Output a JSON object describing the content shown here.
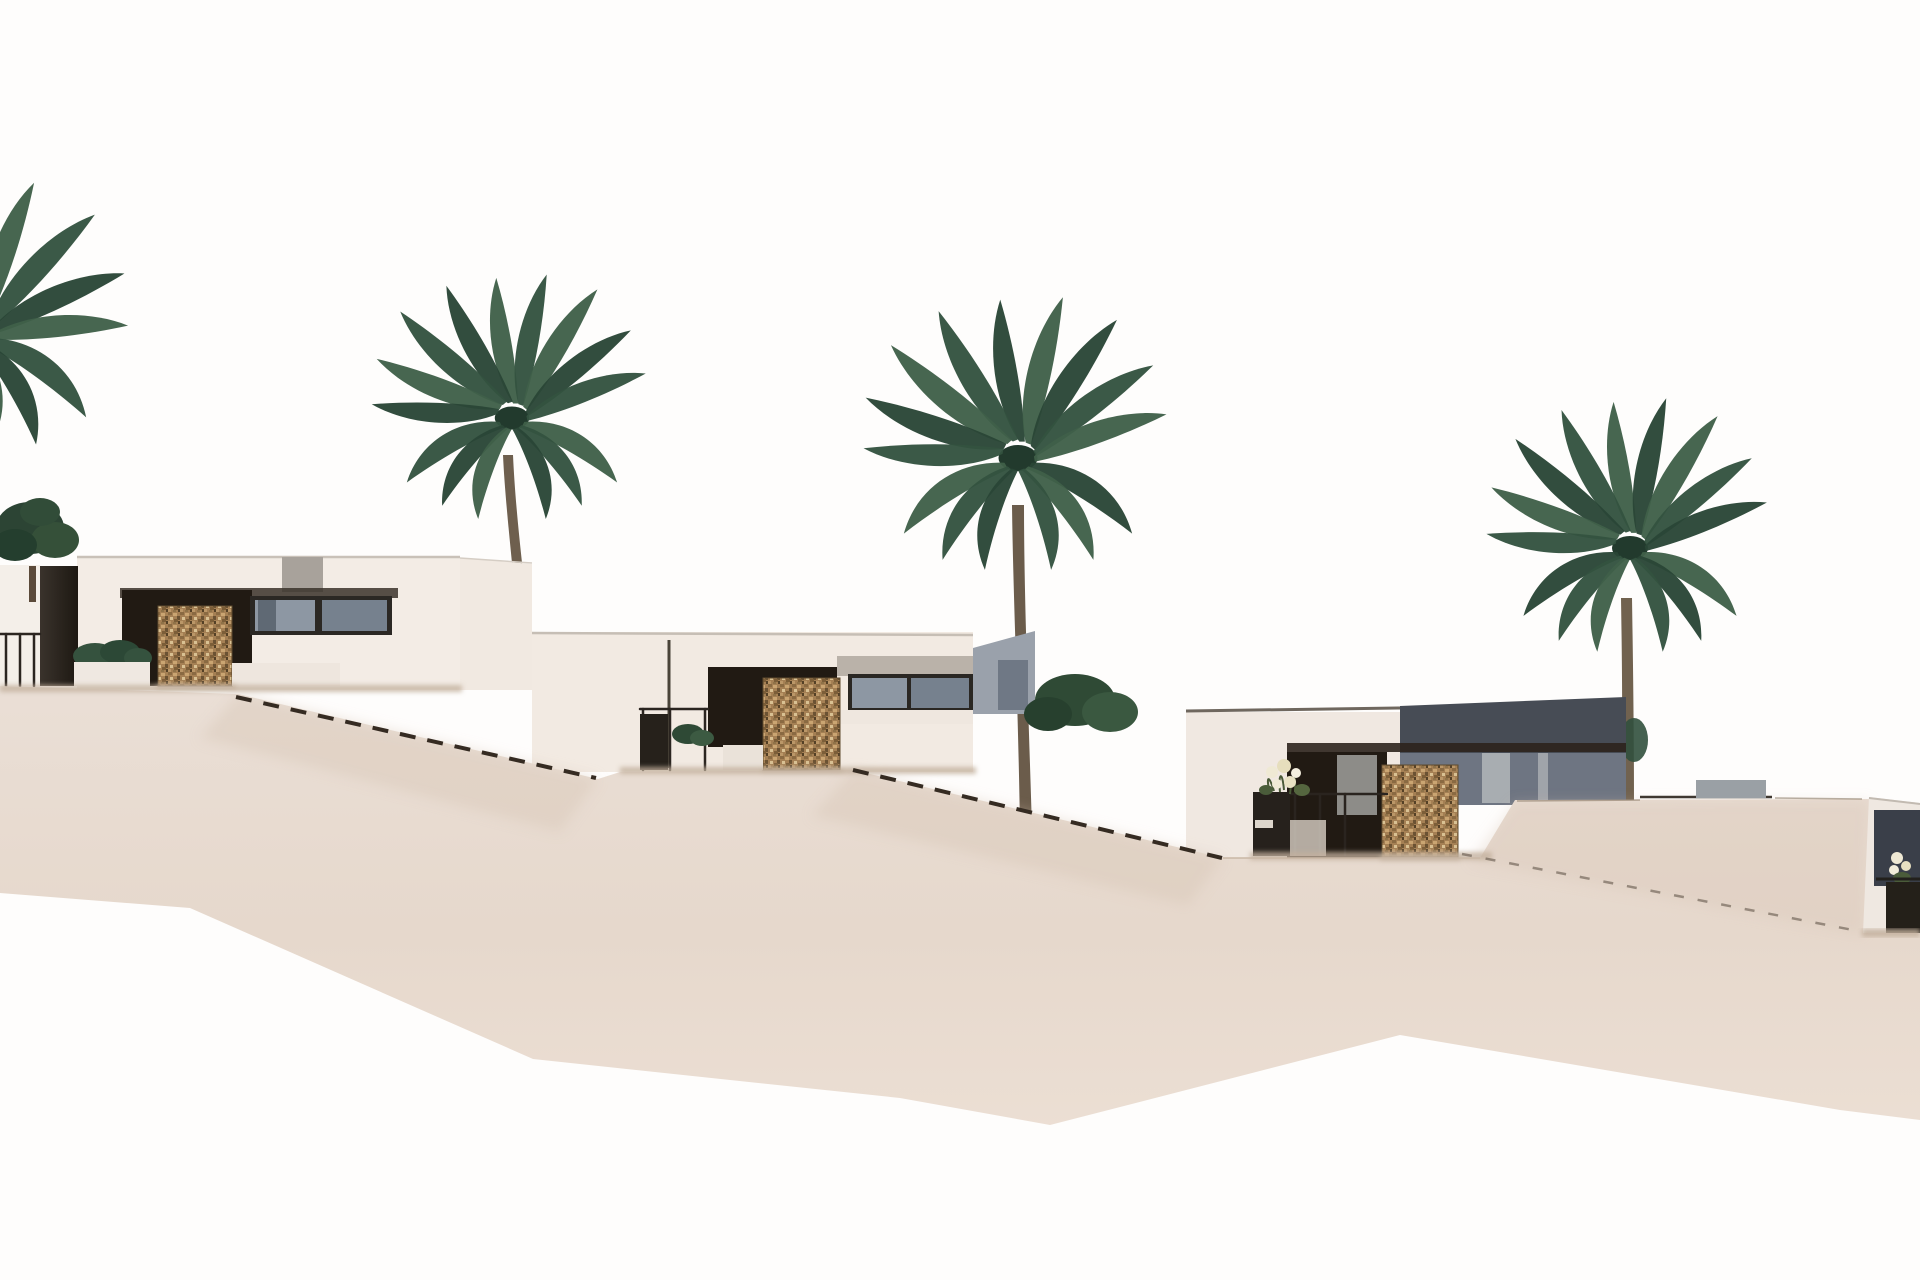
{
  "meta": {
    "image_type": "architectural-3d-render",
    "description": "New-build modern villas on a terraced sandy hillside with palm trees against a white sky",
    "width_px": 1920,
    "height_px": 1280
  },
  "colors": {
    "sky": "#fefdfc",
    "sand": "#e8dcd2",
    "sandTop": "#ebe0d7",
    "sandDeep": "#e4d5c8",
    "bankShade": "#d8c5b4",
    "groundShadow": "#c3b09d",
    "wall1": "#f3ece5",
    "wall2": "#f2eae2",
    "wall3": "#f0e8e1",
    "wall4": "#efe8e1",
    "roofLine": "#c9c1b8",
    "roofLine3": "#6f675e",
    "eave": "#3a322a",
    "porch": "#211a13",
    "glassA": "#8d97a3",
    "glassB": "#76818e",
    "frame": "#2b2824",
    "wingGray": "#9aa1ab",
    "upperGray": "#474c55",
    "facadeGray": "#6e7582",
    "doorGray": "#8d8c88",
    "doorStripe": "#b3b7ba",
    "slabGray": "#9aa0a5",
    "stoneEdge": "#5e4a2e",
    "pillar": "#26211b",
    "rail": "#2b2520",
    "dash": "#352b22",
    "dashFaint": "#4a3f33",
    "trunk": "#6e5f4e",
    "palmDark": "#2a4636",
    "palmMid": "#33523f",
    "palmLight": "#3f6049",
    "treeGreen": "#2c4434",
    "shrubGreen": "#35523e",
    "flowerCream": "#efe9d4",
    "planterDark": "#26211c",
    "benchWhite": "#eae2d9"
  },
  "scene": {
    "villas": [
      {
        "name": "villa-1",
        "position": "left",
        "approx_bbox": "0,430,530,690",
        "features": [
          "flat roof",
          "dark porch",
          "gabion stone panel",
          "sliding glass windows",
          "dark pillar",
          "railing",
          "planter with shrub"
        ]
      },
      {
        "name": "villa-2",
        "position": "center-left",
        "approx_bbox": "532,630,1035,772",
        "features": [
          "flat roof",
          "dark porch",
          "gabion stone panel",
          "glass windows",
          "railing",
          "bench",
          "shrub"
        ]
      },
      {
        "name": "villa-3",
        "position": "center-right",
        "approx_bbox": "1186,697,1626,858",
        "features": [
          "flat roof",
          "dark clerestory band",
          "dark porch",
          "gabion stone panel",
          "flower planter",
          "railing",
          "gray side facade"
        ]
      },
      {
        "name": "villa-4",
        "position": "far-right-edge",
        "approx_bbox": "1863,797,1920,933",
        "features": [
          "dark window",
          "flowers",
          "railing",
          "dark planter"
        ]
      }
    ],
    "palm_trees": [
      {
        "name": "palm-edge",
        "crown_center": "-25,332",
        "note": "fronds entering from left edge"
      },
      {
        "name": "palm-2",
        "crown_center": "512,418"
      },
      {
        "name": "palm-3",
        "crown_center": "1018,458"
      },
      {
        "name": "palm-4",
        "crown_center": "1630,548"
      }
    ],
    "ornamental_trees": 1,
    "stair_rail_lines": [
      {
        "name": "stair-line-1",
        "from": "236,697",
        "to": "596,778"
      },
      {
        "name": "stair-line-2",
        "from": "853,770",
        "to": "1222,858"
      },
      {
        "name": "stair-line-3",
        "from": "1462,854",
        "to": "1858,931",
        "style": "faint"
      }
    ],
    "terrain": "sandy terraces stepping down left to right, white fade at bottom"
  }
}
